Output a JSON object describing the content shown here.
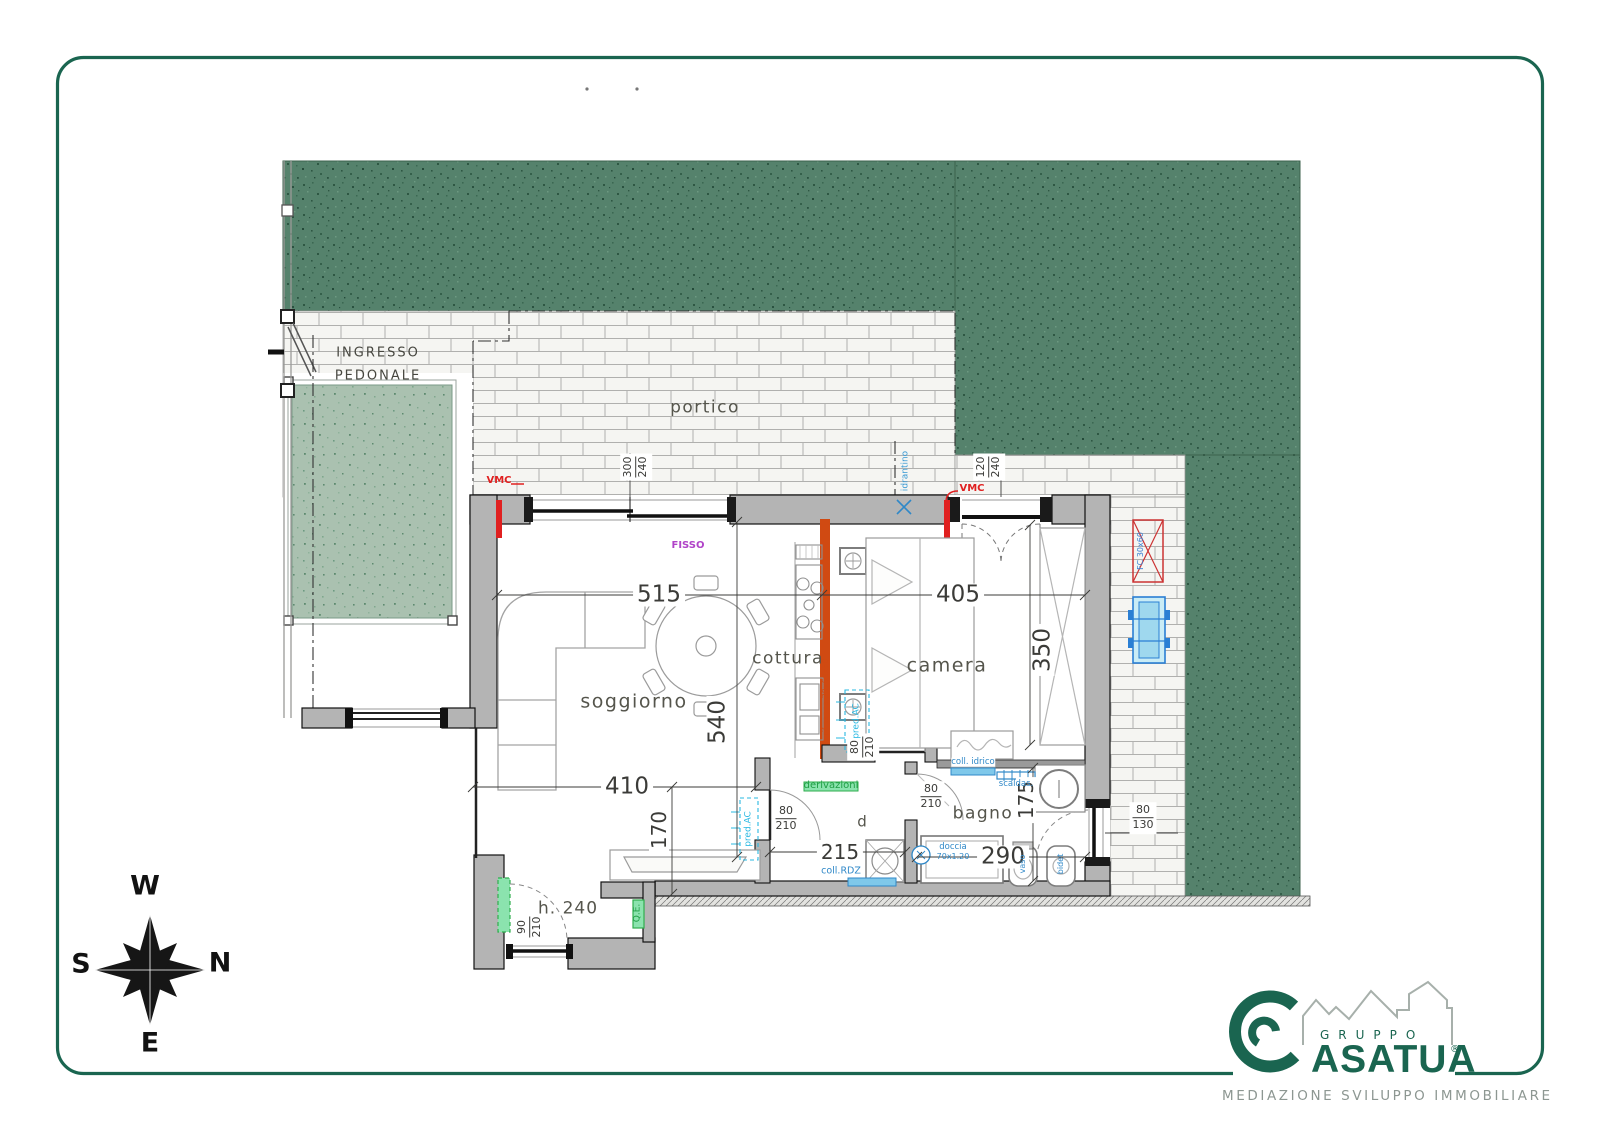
{
  "page": {
    "background": "#ffffff",
    "frame_color": "#1a6550"
  },
  "site": {
    "entrance_label_line1": "INGRESSO",
    "entrance_label_line2": "PEDONALE",
    "portico_label": "portico"
  },
  "rooms": {
    "living": "soggiorno",
    "kitchen": "cottura",
    "bedroom": "camera",
    "bathroom": "bagno",
    "hall": "d",
    "ceiling_height": "h. 240"
  },
  "dims": {
    "living_width": "515",
    "bedroom_width": "405",
    "living_depth": "540",
    "living_width2": "410",
    "living_lower": "170",
    "hall_width": "215",
    "bathroom_width": "290",
    "bedroom_depth": "350",
    "bathroom_depth": "175",
    "living_window": [
      "300",
      "240"
    ],
    "bedroom_door_window": [
      "120",
      "240"
    ],
    "entry_door": [
      "90",
      "210"
    ],
    "bedroom_door": [
      "80",
      "210"
    ],
    "bathroom_door": [
      "80",
      "210"
    ],
    "living_door": [
      "80",
      "210"
    ],
    "bathroom_window": [
      "80",
      "130"
    ]
  },
  "annotations": {
    "vmc": "VMC",
    "fixed_window": "FISSO",
    "hydrant": "idrantino",
    "branches": "derivazioni",
    "water_manifold": "coll. idrico",
    "towel_heater": "scaldas.",
    "shower": "doccia",
    "shower_size": "70x1.20",
    "floor_manifold": "coll.RDZ",
    "electric_panel": "Q.E.",
    "ac_provision": "pred.AC",
    "toilet": "vaso",
    "bidet": "bidet",
    "fan_coil": "FC 30x60",
    "flue": "rif.canna 30x60x50"
  },
  "compass": {
    "top": "W",
    "right": "N",
    "left": "S",
    "bottom": "E"
  },
  "logo": {
    "group_word": "GRUPPO",
    "brand": "ASATUA",
    "registered": "®",
    "tagline": "MEDIAZIONE SVILUPPO IMMOBILIARE"
  },
  "colors": {
    "garden_green": "#54816b",
    "garden_light": "#a9c0af",
    "wall_gray": "#b4b4b4",
    "kitchen_wall_orange": "#d04a12",
    "plumbing_blue": "#2f88c8",
    "electric_green": "#2fae4e",
    "ac_cyan": "#29b8e2",
    "vmc_red": "#e02020",
    "fisso_purple": "#b043c8",
    "logo_green": "#1a6550"
  }
}
